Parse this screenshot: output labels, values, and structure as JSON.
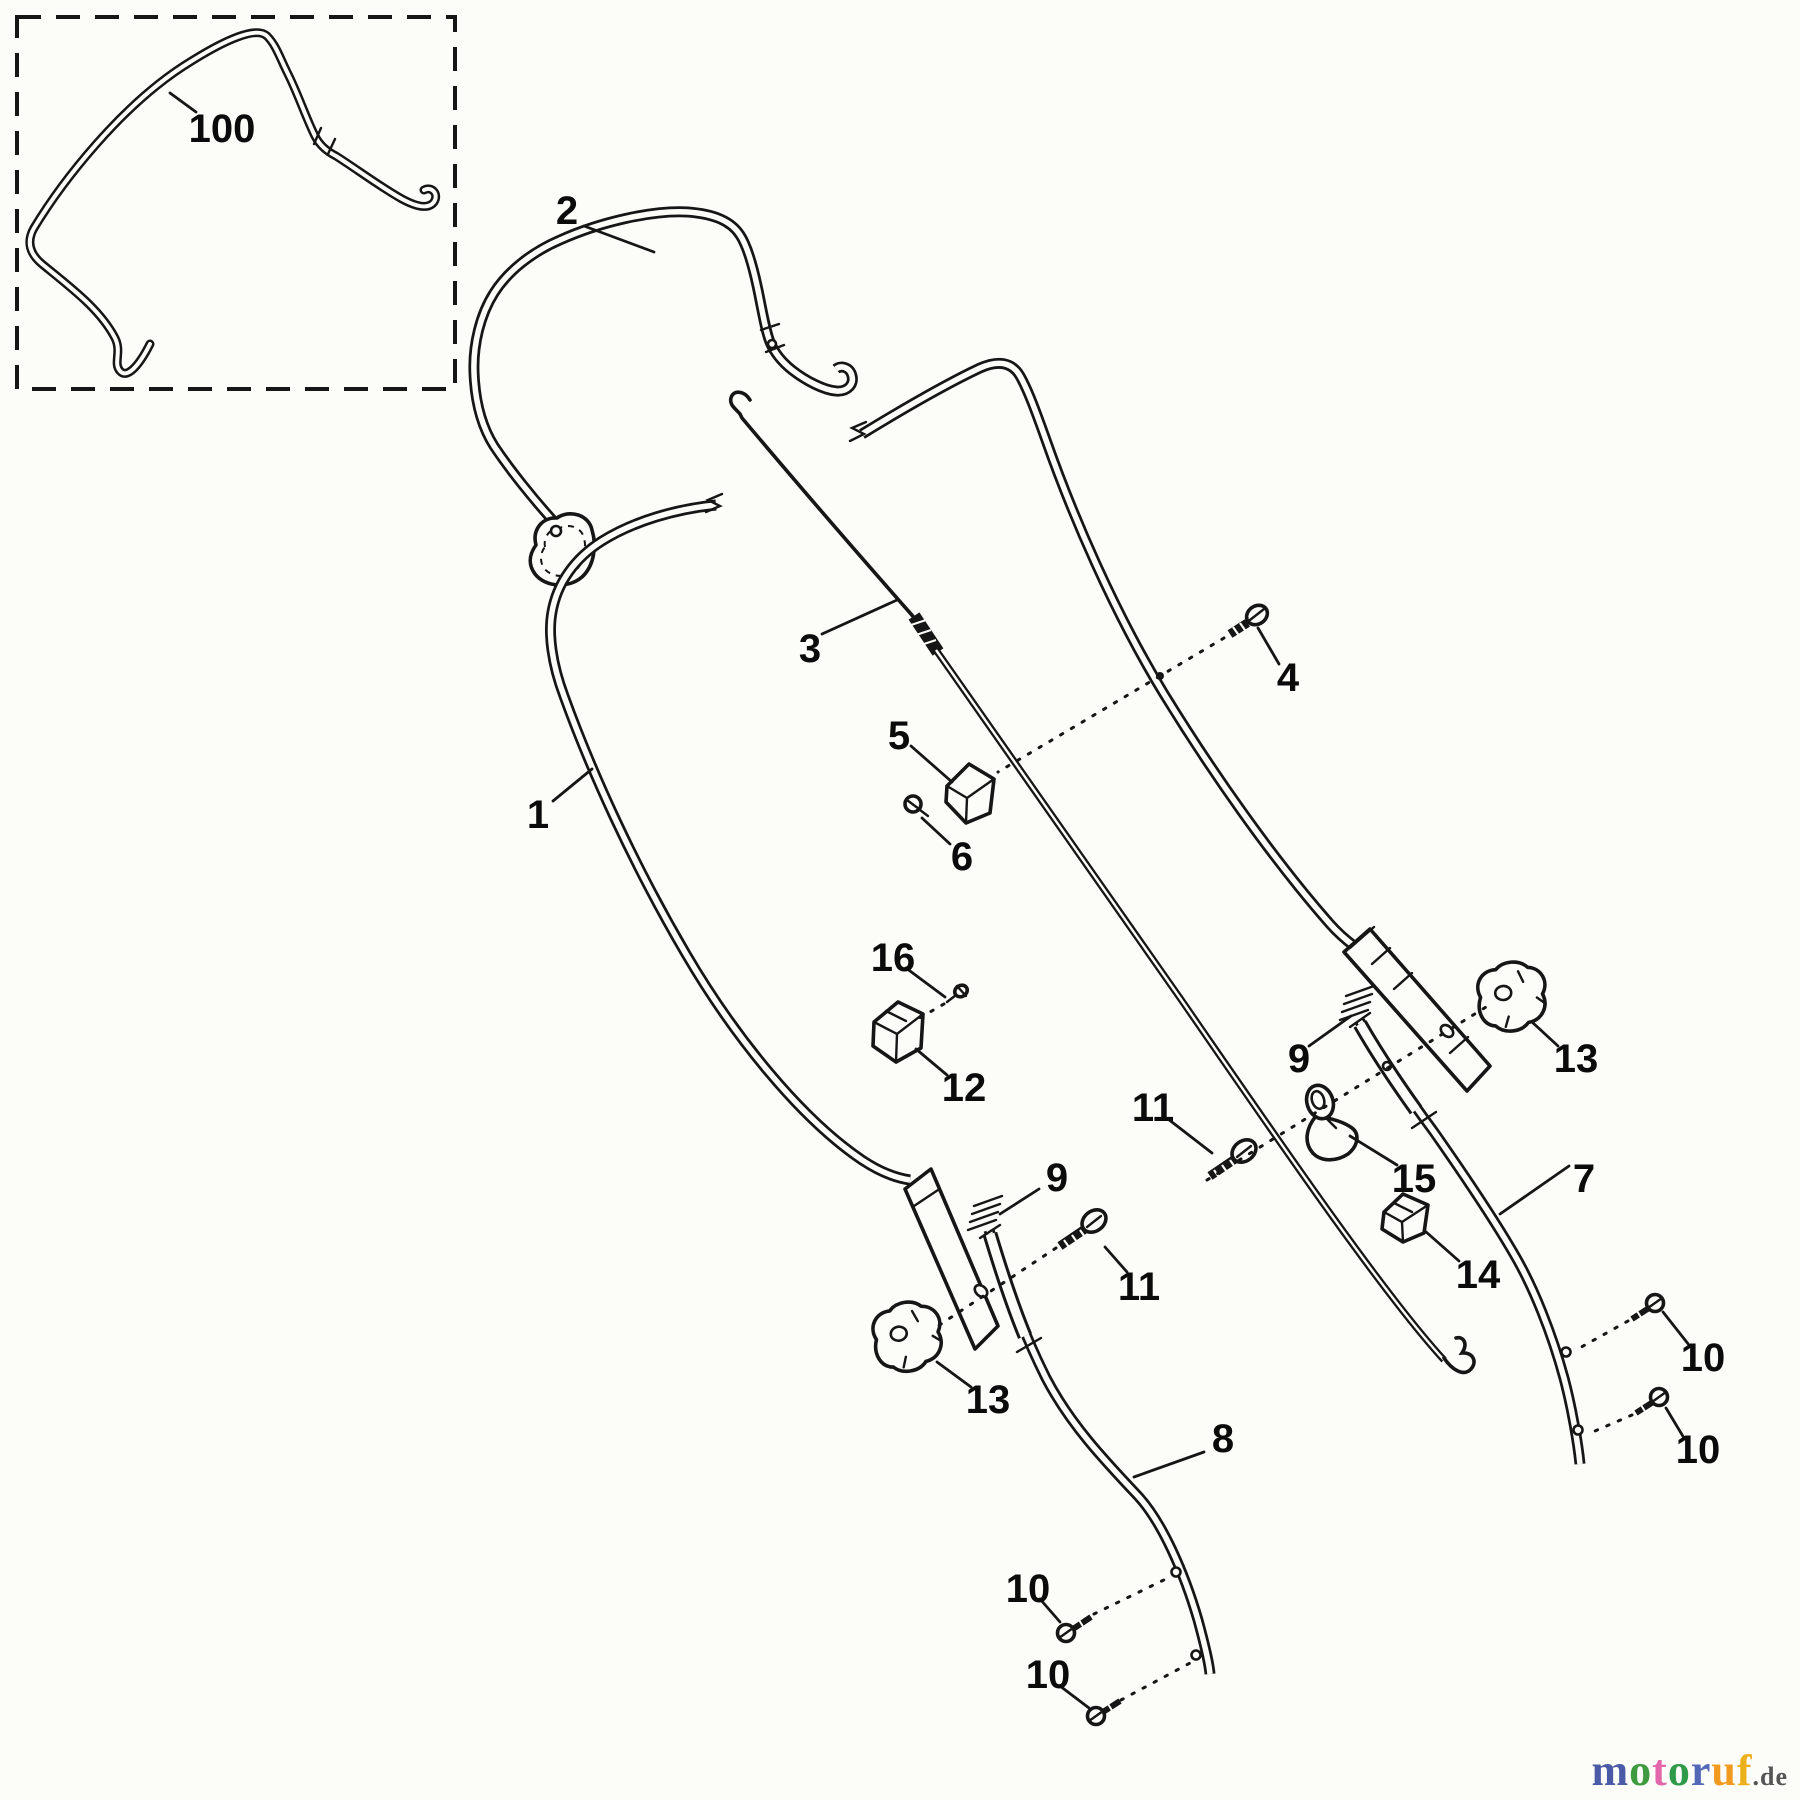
{
  "diagram": {
    "type": "exploded-parts-diagram",
    "subject": "lawn mower handle assembly",
    "background": "#fcfcf8",
    "line_color": "#161616",
    "labels": [
      {
        "id": "100",
        "text": "100",
        "x": 222,
        "y": 128
      },
      {
        "id": "2",
        "text": "2",
        "x": 567,
        "y": 210
      },
      {
        "id": "3",
        "text": "3",
        "x": 810,
        "y": 648
      },
      {
        "id": "1",
        "text": "1",
        "x": 538,
        "y": 814
      },
      {
        "id": "4",
        "text": "4",
        "x": 1288,
        "y": 677
      },
      {
        "id": "5",
        "text": "5",
        "x": 899,
        "y": 735
      },
      {
        "id": "6",
        "text": "6",
        "x": 962,
        "y": 856
      },
      {
        "id": "16",
        "text": "16",
        "x": 893,
        "y": 957
      },
      {
        "id": "12",
        "text": "12",
        "x": 964,
        "y": 1087
      },
      {
        "id": "9-right",
        "text": "9",
        "x": 1299,
        "y": 1058
      },
      {
        "id": "9-left",
        "text": "9",
        "x": 1057,
        "y": 1177
      },
      {
        "id": "11-right",
        "text": "11",
        "x": 1153,
        "y": 1107
      },
      {
        "id": "11-left",
        "text": "11",
        "x": 1139,
        "y": 1286
      },
      {
        "id": "15",
        "text": "15",
        "x": 1414,
        "y": 1178
      },
      {
        "id": "7",
        "text": "7",
        "x": 1584,
        "y": 1178
      },
      {
        "id": "14",
        "text": "14",
        "x": 1478,
        "y": 1274
      },
      {
        "id": "13-right",
        "text": "13",
        "x": 1576,
        "y": 1058
      },
      {
        "id": "13-left",
        "text": "13",
        "x": 988,
        "y": 1399
      },
      {
        "id": "8",
        "text": "8",
        "x": 1223,
        "y": 1438
      },
      {
        "id": "10-right-top",
        "text": "10",
        "x": 1703,
        "y": 1357
      },
      {
        "id": "10-right-bottom",
        "text": "10",
        "x": 1698,
        "y": 1449
      },
      {
        "id": "10-left-top",
        "text": "10",
        "x": 1028,
        "y": 1588
      },
      {
        "id": "10-left-bottom",
        "text": "10",
        "x": 1048,
        "y": 1674
      }
    ],
    "watermark": {
      "word": [
        {
          "ch": "m",
          "color": "#4a5aa6"
        },
        {
          "ch": "o",
          "color": "#3f9b40"
        },
        {
          "ch": "t",
          "color": "#e366ab"
        },
        {
          "ch": "o",
          "color": "#2f9a49"
        },
        {
          "ch": "r",
          "color": "#5468b8"
        },
        {
          "ch": "u",
          "color": "#f29a1f"
        },
        {
          "ch": "f",
          "color": "#edb01d"
        }
      ],
      "suffix": ".de",
      "suffix_color": "#555555"
    }
  }
}
